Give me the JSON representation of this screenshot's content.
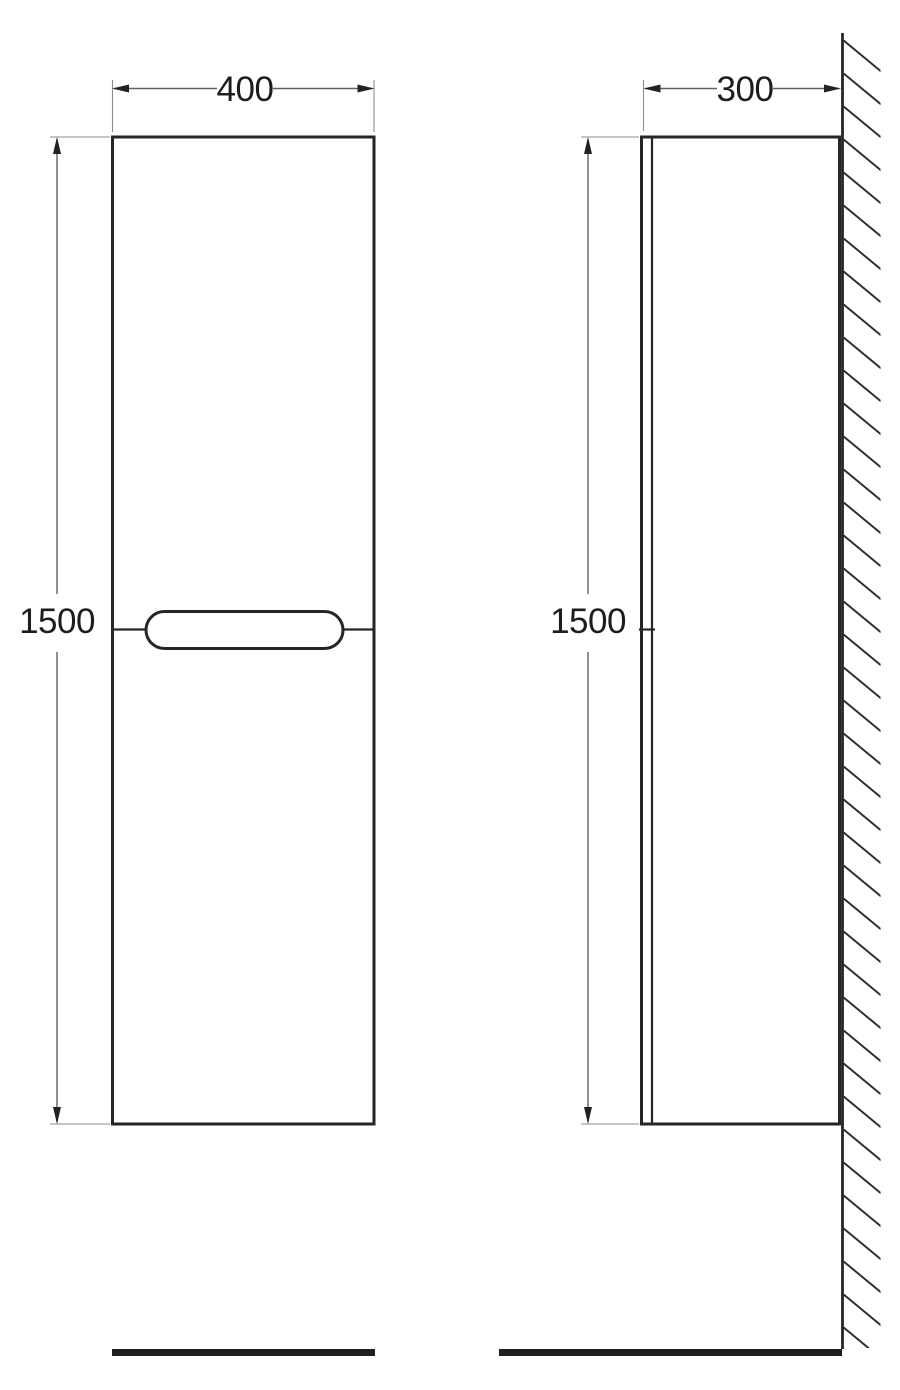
{
  "drawing": {
    "front_view": {
      "width_label": "400",
      "height_label": "1500"
    },
    "side_view": {
      "depth_label": "300",
      "height_label": "1500"
    }
  },
  "colors": {
    "background": "#ffffff",
    "outline": "#262626",
    "dimension": "#606060",
    "extension": "#8c8c8c",
    "arrow": "#222222",
    "text": "#1d1d1d",
    "floor": "#1f1f1f",
    "hatch": "#2e2e2e"
  }
}
